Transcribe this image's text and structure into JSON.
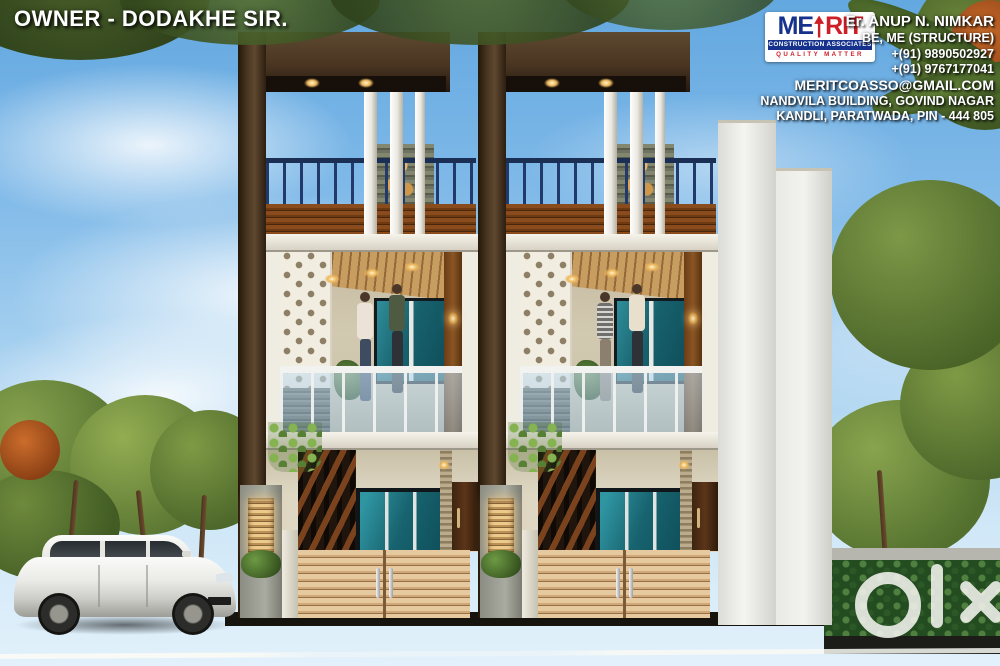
{
  "overlay": {
    "owner_label": "OWNER - DODAKHE SIR.",
    "watermark": "olx"
  },
  "logo": {
    "brand_me": "ME",
    "brand_rit": "RIT",
    "tagline1": "CONSTRUCTION ASSOCIATES",
    "tagline2": "QUALITY MATTER"
  },
  "contact": {
    "engineer": "Er. ANUP N. NIMKAR",
    "qualification": "BE, ME (STRUCTURE)",
    "phone1": "+(91) 9890502927",
    "phone2": "+(91) 9767177041",
    "email": "MERITCOASSO@GMAIL.COM",
    "address_line1": "NANDVILA BUILDING, GOVIND NAGAR",
    "address_line2": "KANDLI, PARATWADA, PIN - 444 805"
  },
  "scene": {
    "subject": "Twin duplex row-house 3D front elevation render with white hatchback car",
    "colors": {
      "sky": "#7fb9e8",
      "frame_brown": "#44311f",
      "slat_brown": "#7c4215",
      "gate_wood": "#dcb98e",
      "glass_teal": "#1d6f7c",
      "railing_navy": "#22396b",
      "road": "#3a3936",
      "foliage": "#6e8d3c",
      "logo_blue": "#16328c",
      "logo_red": "#cf1f26"
    }
  }
}
